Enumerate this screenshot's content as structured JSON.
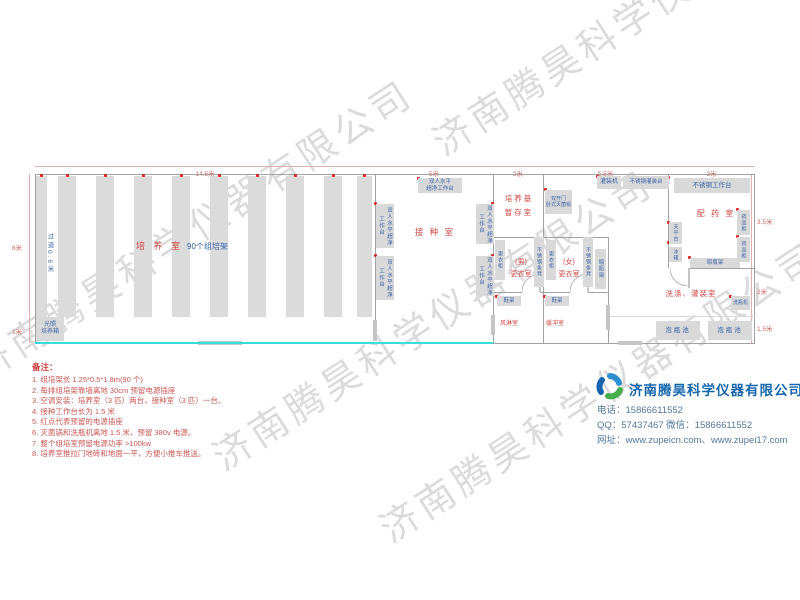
{
  "watermark": "济南腾昊科学仪器有限公司",
  "dimensions": {
    "top": [
      "14.5米",
      "5米",
      "2米",
      "5.5米",
      "3米"
    ],
    "left": [
      "8米",
      "1米"
    ],
    "right": [
      "3.5米",
      "2米",
      "1.5米"
    ]
  },
  "rooms": {
    "culture": "培 养 室",
    "culture_suffix": "90个组培架",
    "aisle": "过道0.6米",
    "inoculation": "接 种 室",
    "medium_storage": [
      "培养基",
      "暂存室"
    ],
    "dressing_male": [
      "(男)",
      "更衣室"
    ],
    "dressing_female": [
      "(女)",
      "更衣室"
    ],
    "air_shower": "风淋室",
    "buffer": "缓冲室",
    "dispensing": "配 药 室",
    "washing": "洗涤、灌装室"
  },
  "equipment": {
    "light_incubator": [
      "光照",
      "培养箱"
    ],
    "clean_bench_h": [
      "双人水平",
      "超净工作台"
    ],
    "clean_bench_v": "双人水平超净工作台",
    "sterilizer": [
      "双开门",
      "卧式灭菌锅"
    ],
    "filling_machine": "灌装机",
    "filling_table": "不锈钢灌装台",
    "ss_workbench": "不锈钢工作台",
    "balance_table": "天平台",
    "fridge": "冰箱",
    "medicine_cabinet": "药品柜",
    "bottle_rack": "晾瓶架",
    "wardrobe": "更衣柜",
    "ss_bench": "不锈钢条凳",
    "shoe_rack": "鞋架",
    "bottle_washer": "洗瓶机",
    "soak_pool": "泡瓶池"
  },
  "notes": {
    "title": "备注：",
    "items": [
      "1. 组培架长 1.25*0.5*1.8m(90 个)",
      "2. 每排组培架靠墙离地 30cm 预留电源插座",
      "3. 空调安装：培养室（3 匹）两台，接种室（3 匹）一台。",
      "4. 接种工作台长为 1.5 米",
      "5. 红点代表预留的电源插座",
      "6. 灭菌锅和洗瓶机离地 1.5 米，预留 380v 电源。",
      "7. 整个组培室预留电源功率 >100kw",
      "8. 培养室推拉门地砖和地面一平，方便小推车推送。"
    ]
  },
  "company": {
    "name": "济南腾昊科学仪器有限公司",
    "phone": "电话：15866611552",
    "qq_wechat": "QQ：57437467    微信：15866611552",
    "website": "网址：www.zupeicn.com、www.zupei17.com"
  }
}
